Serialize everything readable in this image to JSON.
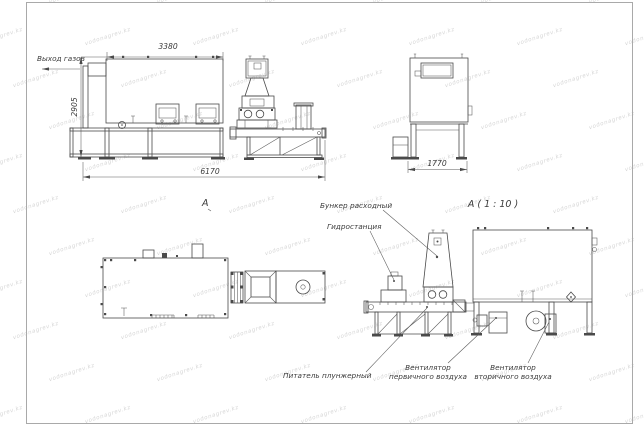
{
  "watermark": {
    "text": "vodonagrev.kz",
    "color": "#d6d6d6"
  },
  "page": {
    "background": "#ffffff",
    "border_color": "#a9a9a9"
  },
  "drawing": {
    "colors": {
      "line": "#4a4a4a",
      "text": "#3b3b3b"
    },
    "labels": {
      "gas_outlet": "Выход газов",
      "view_a": "А",
      "view_a_scale": "А ( 1 : 10 )",
      "bunker": "Бункер расходный",
      "hydro": "Гидростанция",
      "feeder": "Питатель плунжерный",
      "fan_primary": [
        "Вентилятор",
        "первичного воздуха"
      ],
      "fan_secondary": [
        "Вентилятор",
        "вторичного воздуха"
      ]
    },
    "dimensions": {
      "front_width": "3380",
      "front_height": "2905",
      "overall_length": "6170",
      "end_width": "1770"
    }
  }
}
